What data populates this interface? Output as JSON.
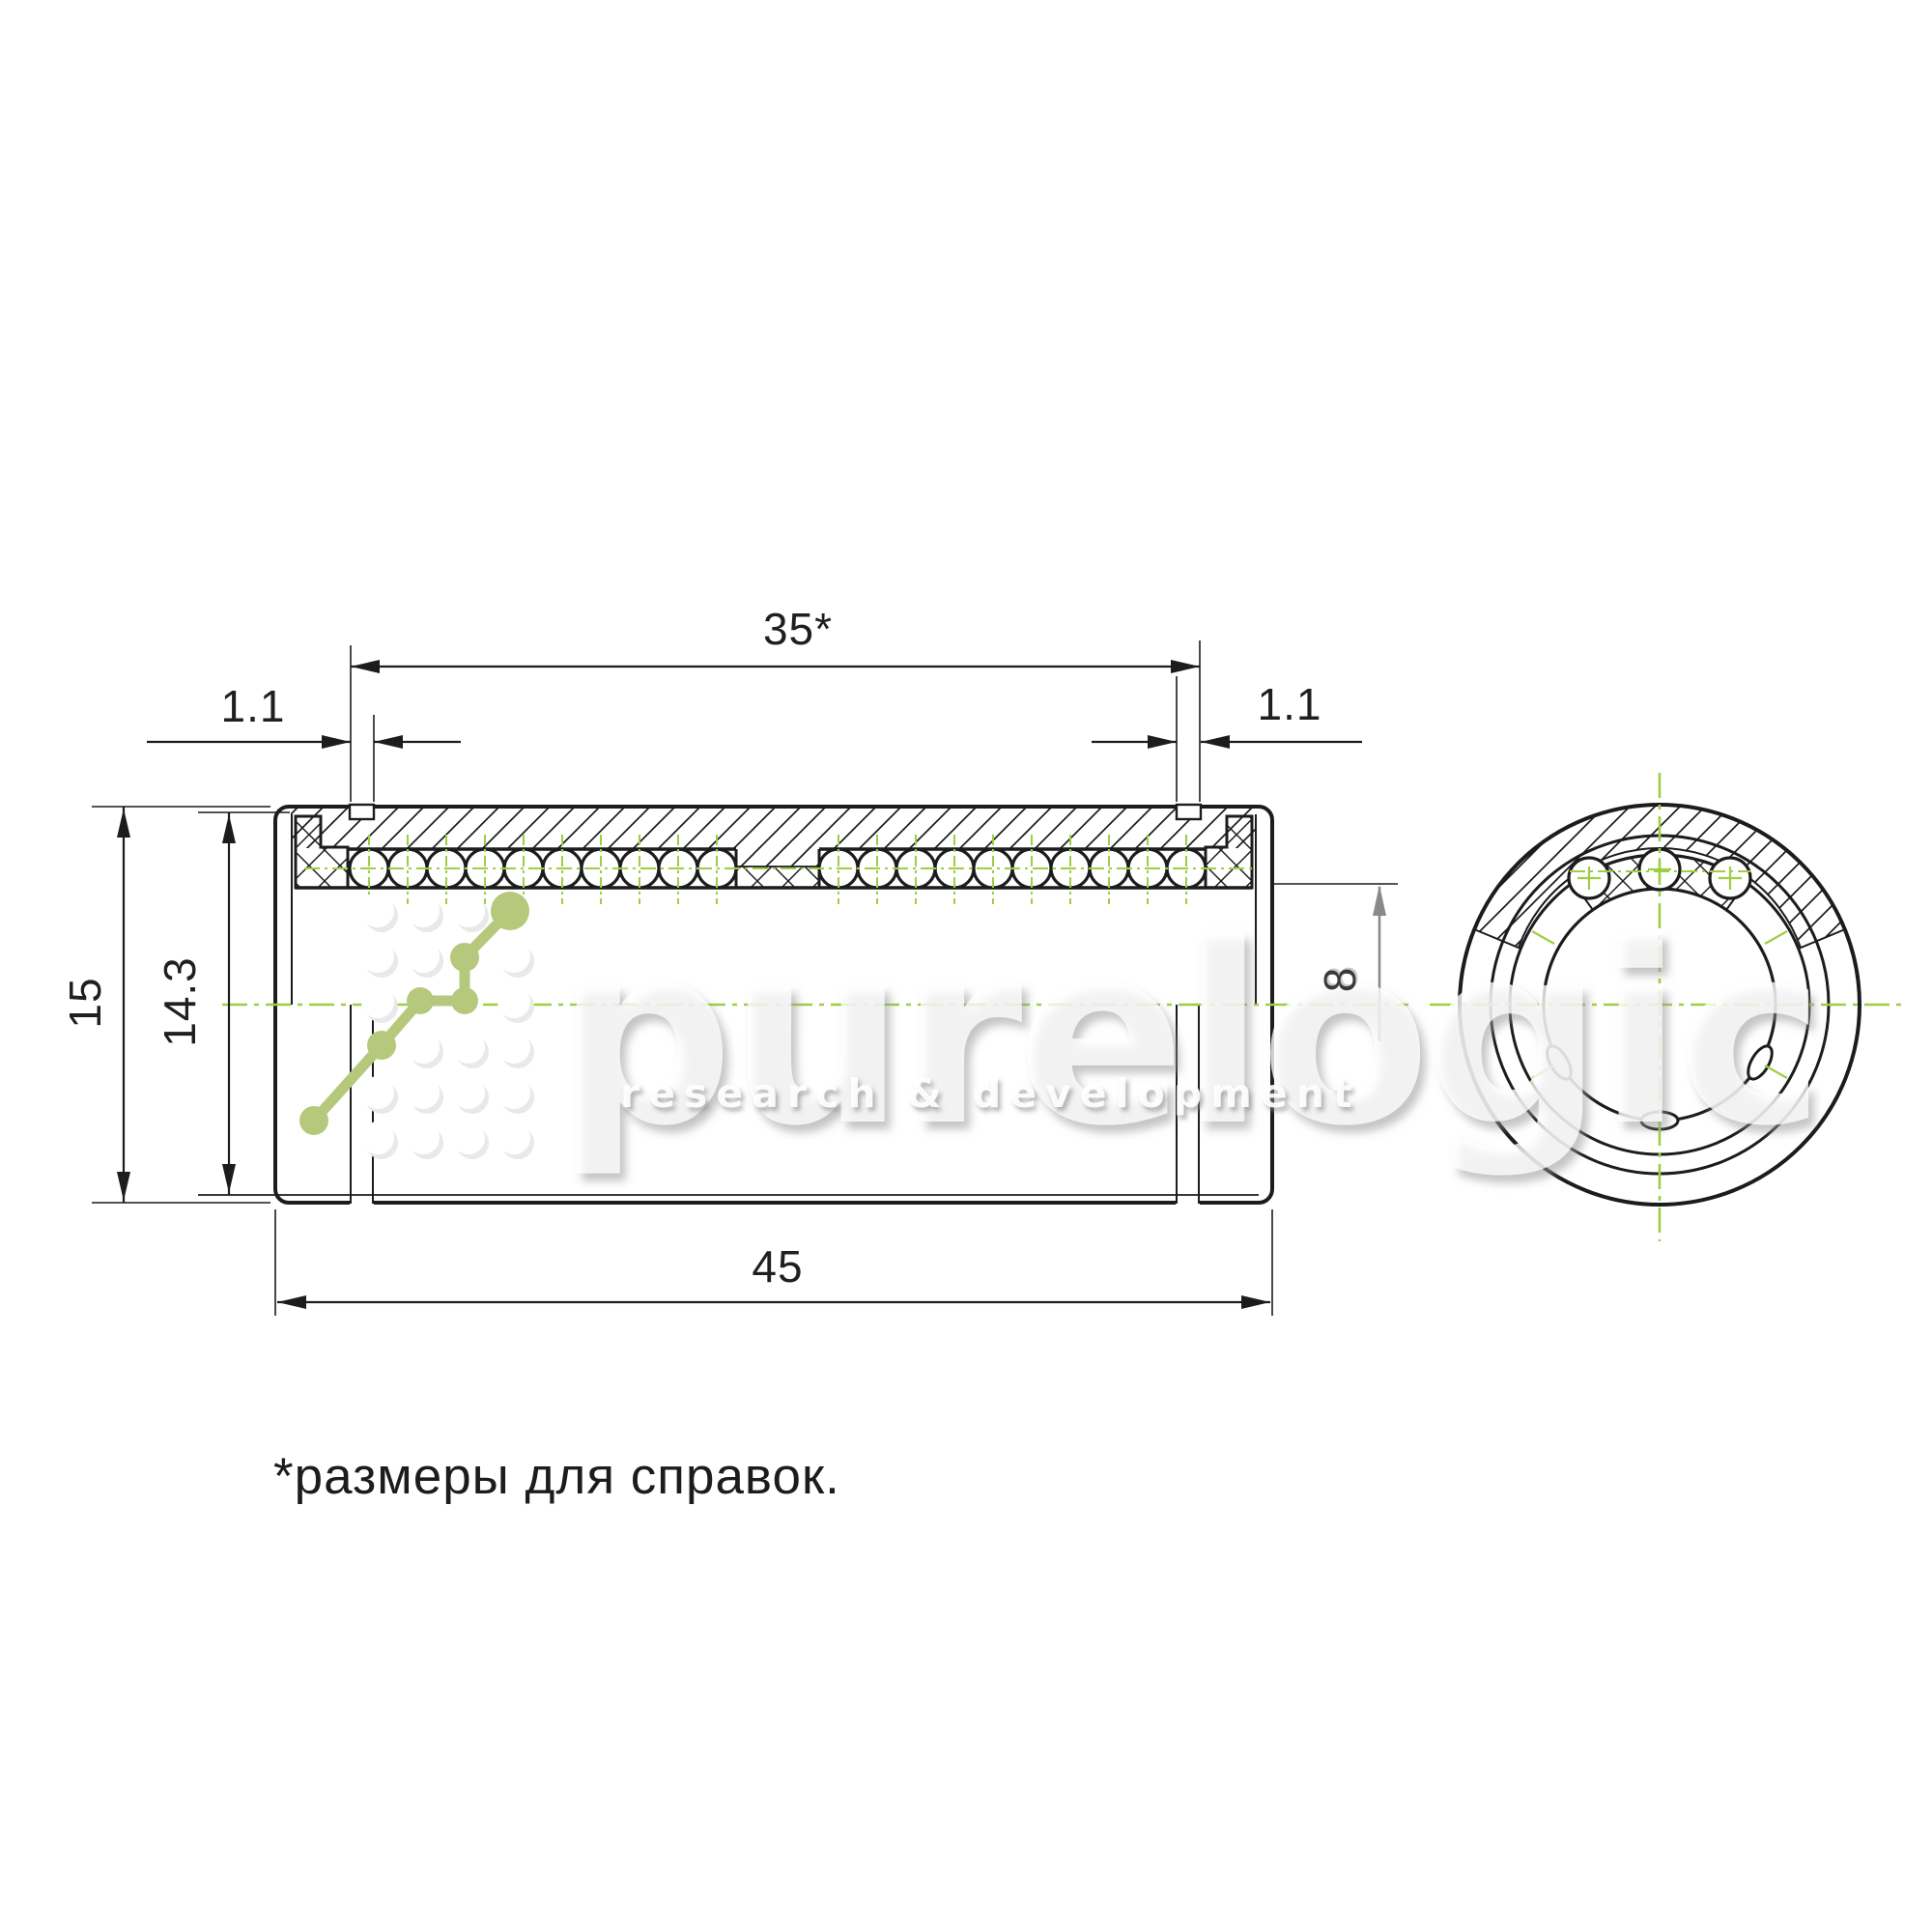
{
  "drawing": {
    "title": "linear ball bushing section drawing",
    "dimensions": {
      "groove_to_groove_length": "35*",
      "groove_width_left": "1.1",
      "groove_width_right": "1.1",
      "outer_diameter": "15",
      "recess_diameter": "14.3",
      "bore_radius_ref": "8",
      "total_length": "45"
    },
    "note": "*размеры для справок.",
    "colors": {
      "line": "#1c1c1c",
      "centerline_green": "#9fce44",
      "logo_green": "#b6c87c",
      "dim_gray": "#8a8a8a"
    }
  },
  "watermark": {
    "brand": "purelogic",
    "tagline": "research & development"
  }
}
